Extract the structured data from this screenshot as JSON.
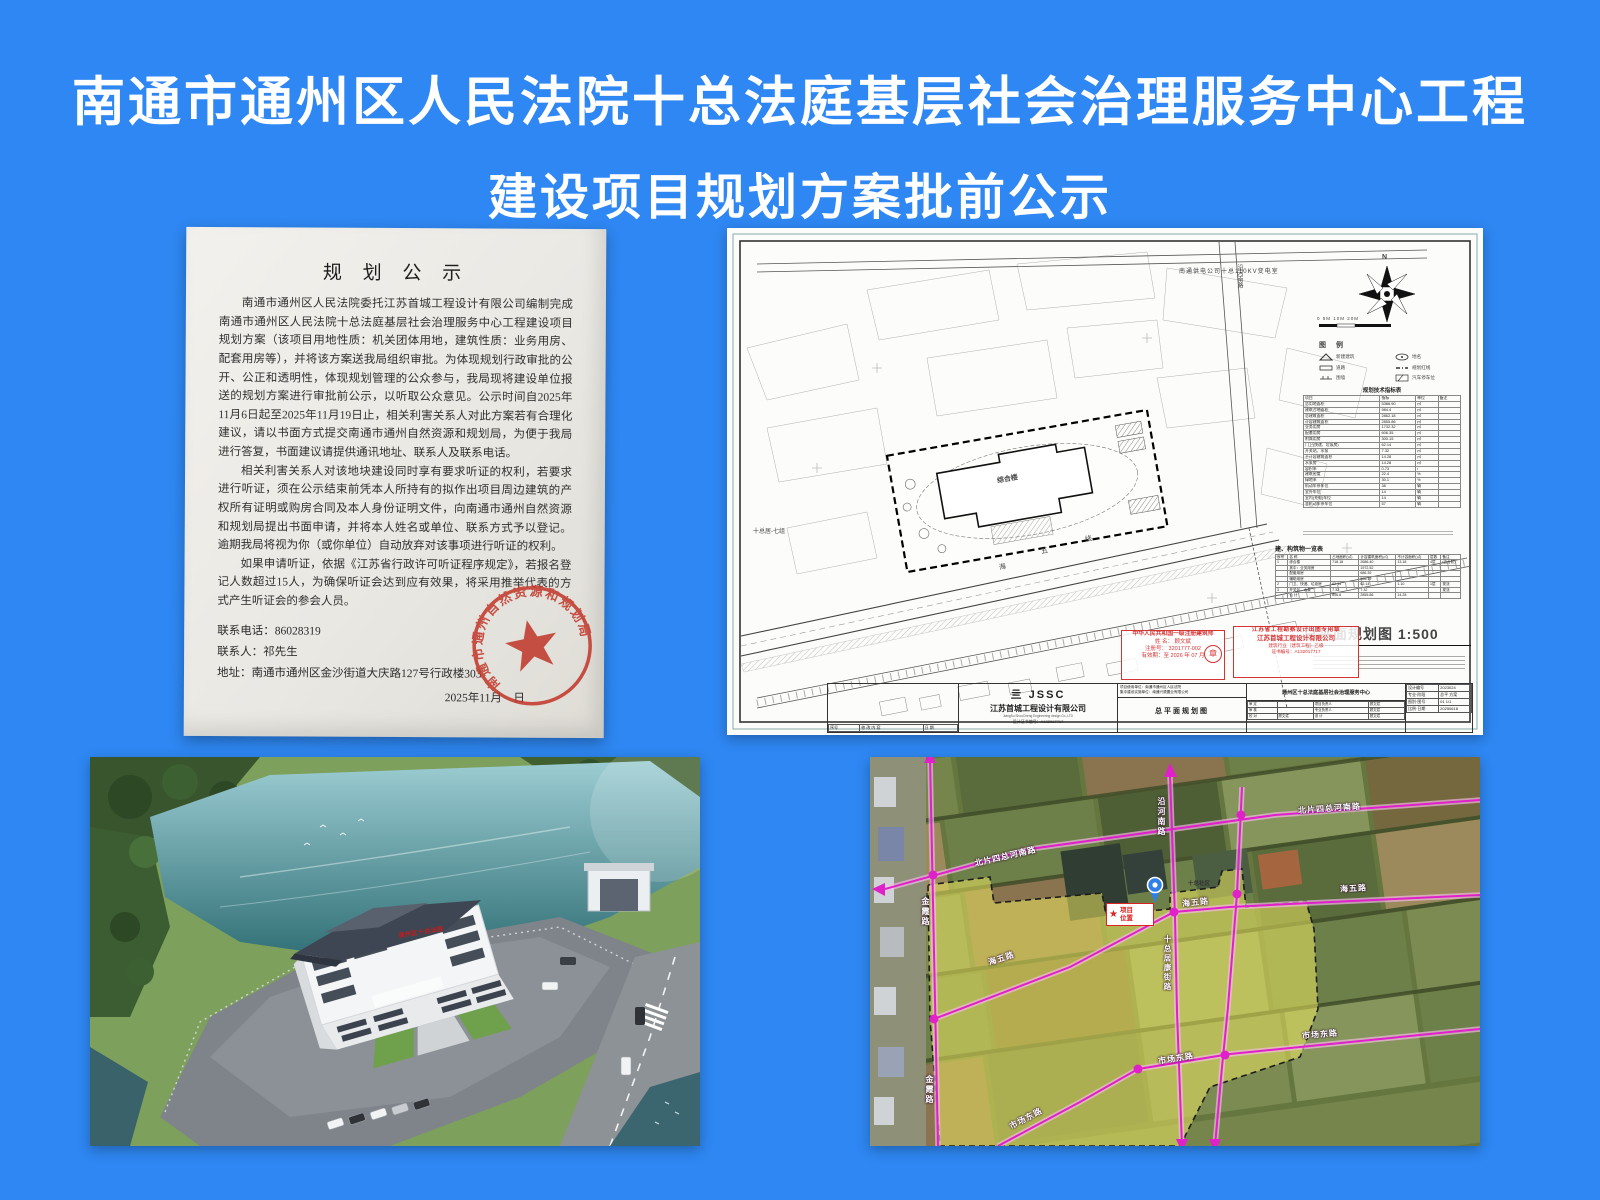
{
  "title": {
    "line1": "南通市通州区人民法院十总法庭基层社会治理服务中心工程",
    "line2": "建设项目规划方案批前公示"
  },
  "notice": {
    "title": "规 划 公 示",
    "p1": "南通市通州区人民法院委托江苏首城工程设计有限公司编制完成南通市通州区人民法院十总法庭基层社会治理服务中心工程建设项目规划方案（该项目用地性质：机关团体用地，建筑性质：业务用房、配套用房等），并将该方案送我局组织审批。为体现规划行政审批的公开、公正和透明性，体现规划管理的公众参与，我局现将建设单位报送的规划方案进行审批前公示，以听取公众意见。公示时间自2025年11月6日起至2025年11月19日止，相关利害关系人对此方案若有合理化建议，请以书面方式提交南通市通州自然资源和规划局，为便于我局进行答复，书面建议请提供通讯地址、联系人及联系电话。",
    "p2": "相关利害关系人对该地块建设同时享有要求听证的权利，若要求进行听证，须在公示结束前凭本人所持有的拟作出项目周边建筑的产权所有证明或购房合同及本人身份证明文件，向南通市通州自然资源和规划局提出书面申请，并将本人姓名或单位、联系方式予以登记。逾期我局将视为你（或你单位）自动放弃对该事项进行听证的权利。",
    "p3": "如果申请听证，依据《江苏省行政许可听证程序规定》，若报名登记人数超过15人，为确保听证会达到应有效果，将采用推举代表的方式产生听证会的参会人员。",
    "phone": "联系电话：86028319",
    "person": "联系人：祁先生",
    "address": "地址：南通市通州区金沙街道大庆路127号行政楼303",
    "date": "2025年11月　日",
    "stamp_ring": "南通市通州自然资源和规划局"
  },
  "plan": {
    "top_label": "南通供电公司十总110KV变电室",
    "parcel_label": "十总居-七组",
    "road_char1": "海",
    "road_char2": "五",
    "road_char3": "线",
    "right_road": "沿河南路",
    "building": "综合楼",
    "compass_n": "N",
    "scale": "0   5M   10M        20M",
    "legend_title": "图 例",
    "legend": {
      "i1": "新建建筑",
      "i2": "地名",
      "i3": "道路",
      "i4": "规划红线",
      "i5": "围墙",
      "i6": "汽车停车位"
    },
    "ind_table": {
      "title": "规划技术指标表",
      "headers": [
        "项目",
        "指标",
        "单位",
        "备注"
      ],
      "rows": [
        [
          "总用地面积",
          "5386.90",
          "㎡",
          ""
        ],
        [
          "建筑占地面积",
          "984.4",
          "㎡",
          ""
        ],
        [
          "总建筑面积",
          "2862.18",
          "㎡",
          ""
        ],
        [
          "计容建筑面积",
          "2855.86",
          "㎡",
          ""
        ],
        [
          "业务用房",
          "1732.32",
          "㎡",
          ""
        ],
        [
          "配套用房",
          "606.35",
          "㎡",
          ""
        ],
        [
          "附属用房",
          "300.15",
          "㎡",
          ""
        ],
        [
          "门卫(快递、垃圾房)",
          "62.14",
          "㎡",
          ""
        ],
        [
          "开关站、水泵",
          "7.32",
          "㎡",
          ""
        ],
        [
          "不计容建筑面积",
          "14.28",
          "㎡",
          ""
        ],
        [
          "水泵房",
          "14.28",
          "㎡",
          ""
        ],
        [
          "容积率",
          "0.73",
          "/",
          ""
        ],
        [
          "建筑密度",
          "22.4",
          "%",
          ""
        ],
        [
          "绿地率",
          "30.1",
          "%",
          ""
        ],
        [
          "机动车停车位",
          "38",
          "辆",
          ""
        ],
        [
          "室外车位",
          "14",
          "辆",
          ""
        ],
        [
          "室内(充电)车位",
          "14",
          "辆",
          ""
        ],
        [
          "非机动车停车位",
          "57",
          "辆",
          ""
        ]
      ]
    },
    "list_table": {
      "title": "建、构筑物一览表",
      "headers": [
        "序号",
        "名 称",
        "占地面积(㎡)",
        "计容建筑面积(㎡)",
        "不计容面积(㎡)",
        "层数",
        "备注"
      ],
      "rows": [
        [
          "1",
          "综合楼",
          "718.18",
          "2686.40",
          "13.18",
          "4层",
          "(含台阶)"
        ],
        [
          "",
          "其中：业务用房",
          "",
          "1972.52",
          "",
          "",
          ""
        ],
        [
          "",
          "配套用房",
          "",
          "686.39",
          "",
          "",
          ""
        ],
        [
          "",
          "辅助用房",
          "",
          "505.19",
          "",
          "",
          ""
        ],
        [
          "2",
          "门卫、快递、垃圾房",
          "62.14",
          "62.14",
          "1.10",
          "1层",
          "现浇"
        ],
        [
          "3",
          "开关站、水泵",
          "7.32",
          "7.32",
          "",
          "",
          "现浇"
        ],
        [
          "",
          "合 计",
          "806.6",
          "2855.86",
          "14.28",
          "",
          ""
        ]
      ]
    },
    "main_title": "总平面规划图  1:500",
    "notes_title": "说明：",
    "stamp1": {
      "l1": "中华人民共和国一级注册建筑师",
      "l2": "姓 名： 顾文斌",
      "l3": "注册号： 3201777-002",
      "l4": "有效期：至 2026 年 07 月",
      "seal": "章"
    },
    "stamp2": {
      "l1": "江苏省工程勘察设计出图专用章",
      "l2": "江苏首城工程设计有限公司",
      "l3": "建筑行业（建筑工程）乙级",
      "l4": "证书编号：A132017717"
    },
    "tb": {
      "logo": "亖 JSSC",
      "company": "江苏首城工程设计有限公司",
      "company_en": "JiangSu ShouCheng Engineering design Co.,LTD",
      "cert": "设计证书编号：A132017717",
      "rev_table": {
        "headers": [],
        "rows": [
          [
            "序号",
            "修 改 内 容",
            "日 期"
          ]
        ]
      },
      "use_unit": "项目使用单位：南通市通州区人民法院",
      "build_unit": "集中建设实施单位：南通兴顺置业有限公司",
      "drawing_name": "总平面规划图",
      "project": "通州区十总法庭基层社会治理服务中心",
      "sign_table": {
        "headers": [],
        "rows": [
          [
            "审 定",
            "",
            "项目负责人",
            "顾文斌"
          ],
          [
            "审 核",
            "",
            "专业负责人",
            "顾文斌"
          ],
          [
            "校 对",
            "顾文斌",
            "设 计",
            "顾文斌"
          ]
        ]
      },
      "info_table": {
        "headers": [],
        "rows": [
          [
            "设计编号",
            "2023024"
          ],
          [
            "专业·阶段",
            "总平  方案"
          ],
          [
            "图别·图号",
            "01   1/1"
          ],
          [
            "比例·日期",
            "20250618"
          ]
        ]
      }
    }
  },
  "render": {
    "sign": "通州区十总法庭"
  },
  "map": {
    "beipian": "北片四总河南路",
    "yanhe": "沿河南路",
    "haiwu": "海五路",
    "jinxia": "金霞路",
    "jukang": "十总居康街路",
    "shichang": "市场东路",
    "zone": "十总社区",
    "star": "★",
    "marker1": "项目",
    "marker2": "位置"
  }
}
